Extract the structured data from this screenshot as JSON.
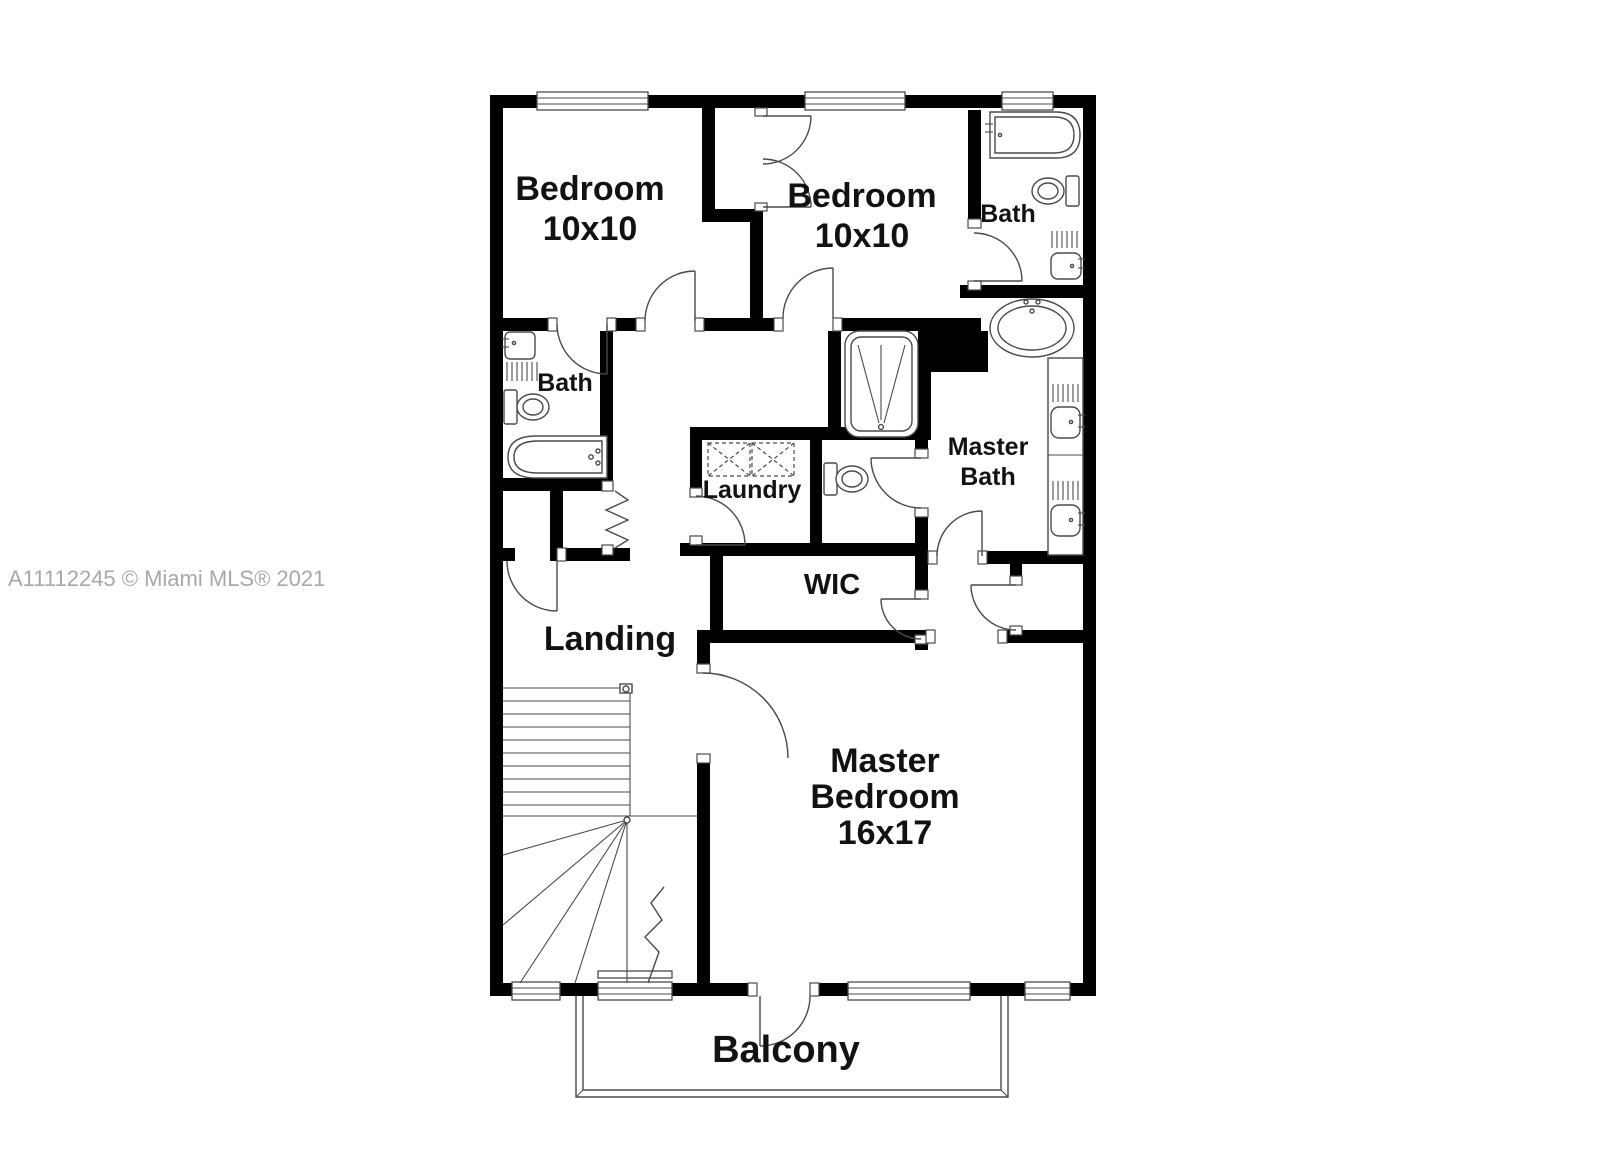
{
  "watermark": {
    "text": "A11112245 © Miami MLS® 2021",
    "color": "#a8a8a8"
  },
  "floor_plan": {
    "labels": {
      "bedroom_top_left": {
        "line1": "Bedroom",
        "line2": "10x10"
      },
      "bedroom_top_middle": {
        "line1": "Bedroom",
        "line2": "10x10"
      },
      "bath_top_right": "Bath",
      "bath_left": "Bath",
      "laundry": "Laundry",
      "master_bath": {
        "line1": "Master",
        "line2": "Bath"
      },
      "wic": "WIC",
      "landing": "Landing",
      "master_bedroom": {
        "line1": "Master",
        "line2": "Bedroom",
        "line3": "16x17"
      },
      "balcony": "Balcony"
    },
    "colors": {
      "walls": "#000000",
      "fixture_lines": "#4a4a4a",
      "text": "#121212",
      "background": "#ffffff",
      "watermark": "#a8a8a8"
    }
  }
}
